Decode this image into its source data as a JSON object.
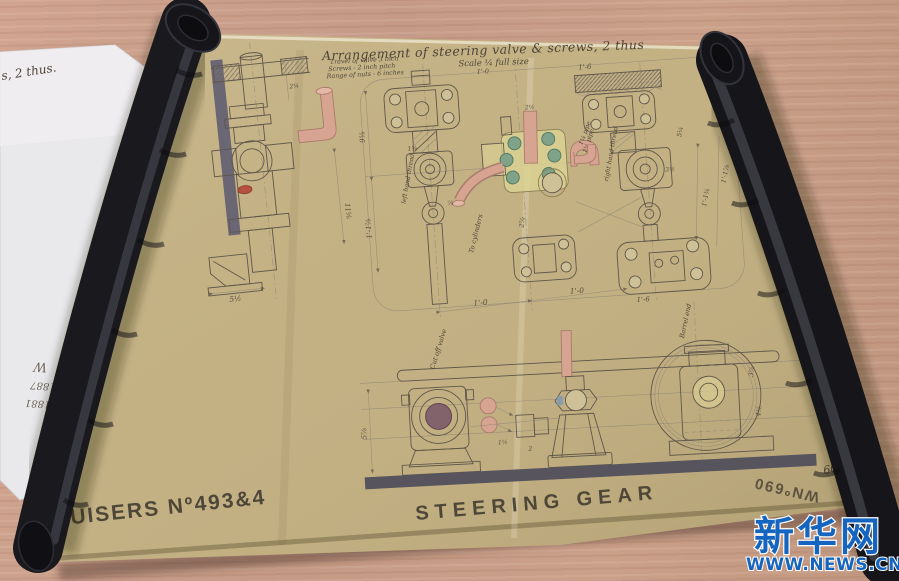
{
  "watermark": {
    "brand": "新华网",
    "site": "WWW.NEWS.CN",
    "color": "#1565c0"
  },
  "white_paper": {
    "top_note": "s, 2 thus.",
    "block": [
      "1881",
      "1887",
      "W"
    ]
  },
  "sheet": {
    "title": "Arrangement of steering valve & screws, 2 thus",
    "scale": "Scale ¼ full size",
    "scale_sub": "1'-0",
    "notes": [
      "Travel of valve 3 inch",
      "Screws - 2 inch pitch",
      "Range of nuts - 6 inches"
    ],
    "stencil_left": "RUISERS Nº493&4",
    "stencil_center": "STEERING GEAR",
    "stencil_upside_down": "WNº690",
    "hand_number": "6030",
    "hand_date": "17/12",
    "labels": {
      "left_thread": "left hand thread",
      "right_thread": "right hand thread",
      "to_cylinders": "To cylinders",
      "cut_off": "Cut off valve",
      "pipe_left": "1¼ pipe",
      "pipe_right": "1¼ pipe",
      "barrel": "Barrel end"
    },
    "dims": {
      "d1": "5½",
      "d2": "11⅝",
      "d3": "2¼",
      "d4": "9⅝",
      "d5": "1'-1⅞",
      "d6": "1'-0",
      "d7": "1'-0",
      "d8": "1'-6",
      "d9": "1'-6",
      "d10": "2⅞",
      "d11": "1⅛",
      "d12": "⅞",
      "d13": "5¼",
      "d14": "3½",
      "d15": "1'-1¾",
      "d16": "1'-1⅞",
      "d17": "5⅞",
      "d18": "3⅞",
      "d19": "4⅝",
      "d20": "1½",
      "d21": "2",
      "d22": "2½"
    }
  }
}
